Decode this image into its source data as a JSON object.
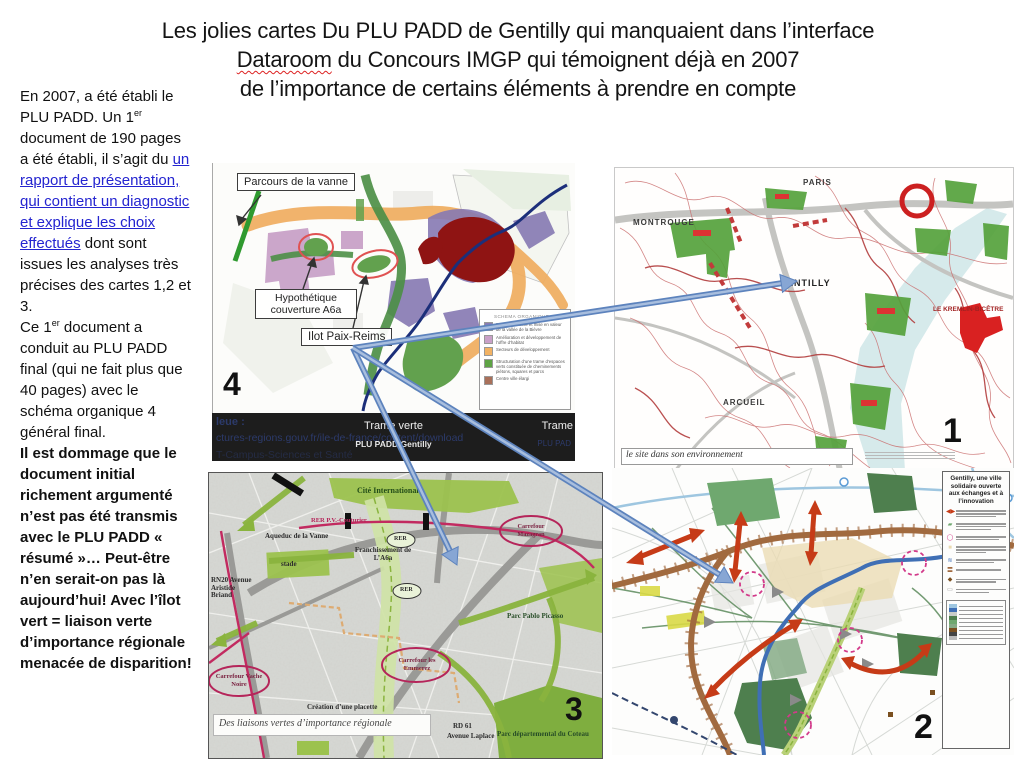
{
  "title": {
    "line1": "Les jolies cartes Du PLU PADD de Gentilly qui manquaient dans l’interface",
    "line2a": "Dataroom",
    "line2b": " du Concours IMGP qui témoignent déjà en 2007",
    "line3": "de l’importance de certains éléments à prendre en compte"
  },
  "sidebar": {
    "p1a": "En 2007, a été établi le PLU PADD. Un 1",
    "p1sup": "er",
    "p1b": " document de 190 pages a été établi, il s’agit du ",
    "link": "un rapport de présentation, qui contient un diagnostic et explique les choix effectués",
    "p1c": " dont sont issues les analyses très précises des cartes 1,2 et 3.",
    "p2a": "Ce 1",
    "p2sup": "er",
    "p2b": " document a conduit au PLU PADD final (qui ne fait plus que 40 pages) avec le schéma organique 4 général final.",
    "p3": "Il est dommage que le document initial richement argumenté n’est pas été transmis avec le PLU PADD « résumé »… Peut-être n’en serait-on pas là aujourd’hui! Avec l’îlot vert = liaison verte d’importance régionale menacée de disparition!"
  },
  "map4": {
    "number": "4",
    "label_parcours": "Parcours de la vanne",
    "label_couverture": "Hypothétique couverture A6a",
    "label_ilot": "Ilot Paix-Reims",
    "legend_title": "SCHEMA ORGANIQUE",
    "legend_items": [
      {
        "color": "#8a7cb5",
        "text": "Reconnaissance et mise en valeur de la vallée de la Bièvre"
      },
      {
        "color": "#c9a0c8",
        "text": "Amélioration et développement de l’offre d’habitat"
      },
      {
        "color": "#f2b263",
        "text": "Secteurs de développement"
      },
      {
        "color": "#5ea345",
        "text": "Structuration d’une trame d’espaces verts constituée de cheminements piétons, squares et parcs"
      },
      {
        "color": "#a9705a",
        "text": "Centre ville élargi"
      }
    ]
  },
  "banner": {
    "left_title": "leue :",
    "left_url": "ctures-regions.gouv.fr/ile-de-france/content/download",
    "left_url2": "T-Campus-Sciences et Santé",
    "center_title": "Trame verte",
    "center_sub": "PLU PADD Gentilly",
    "right_title": "Trame",
    "right_sub": "PLU PAD"
  },
  "map1": {
    "number": "1",
    "caption": "le site dans son environnement",
    "labels": {
      "paris": "PARIS",
      "montrouge": "MONTROUGE",
      "gentilly": "GENTILLY",
      "arcueil": "ARCUEIL",
      "kremlin": "LE KREMLIN-BICÊTRE"
    }
  },
  "map3": {
    "number": "3",
    "caption": "Des liaisons vertes d’importance régionale",
    "labels": {
      "cite": "Cité Internationale",
      "rer_pv": "RER P.V.-Couturier",
      "aqueduc": "Aqueduc de la Vanne",
      "stade": "stade",
      "rn20": "RN20 Avenue Aristide Briand",
      "franchissement": "Franchissement de L’A6a",
      "rer1": "RER",
      "rer2": "RER",
      "mazagran": "Carrefour Mazagran",
      "emmerez": "Carrefour les Emmerez",
      "vache": "Carrefour Vache Noire",
      "picasso": "Parc Pablo Picasso",
      "placette": "Création d’une placette",
      "rd": "RD 61",
      "laplace": "Avenue Laplace",
      "coteau": "Parc départemental du Coteau"
    }
  },
  "map2": {
    "number": "2",
    "legend_title": "Gentilly, une ville solidaire ouverte aux échanges et à l’innovation"
  },
  "colors": {
    "link_blue": "#2424d0",
    "arrow_blue": "#87a6d4",
    "banner_bg": "#1d1d1d",
    "map_red_ellipse": "#e05252",
    "map_green": "#5ea345",
    "map_orange": "#f2b263",
    "map_dark_red": "#8f1413"
  }
}
